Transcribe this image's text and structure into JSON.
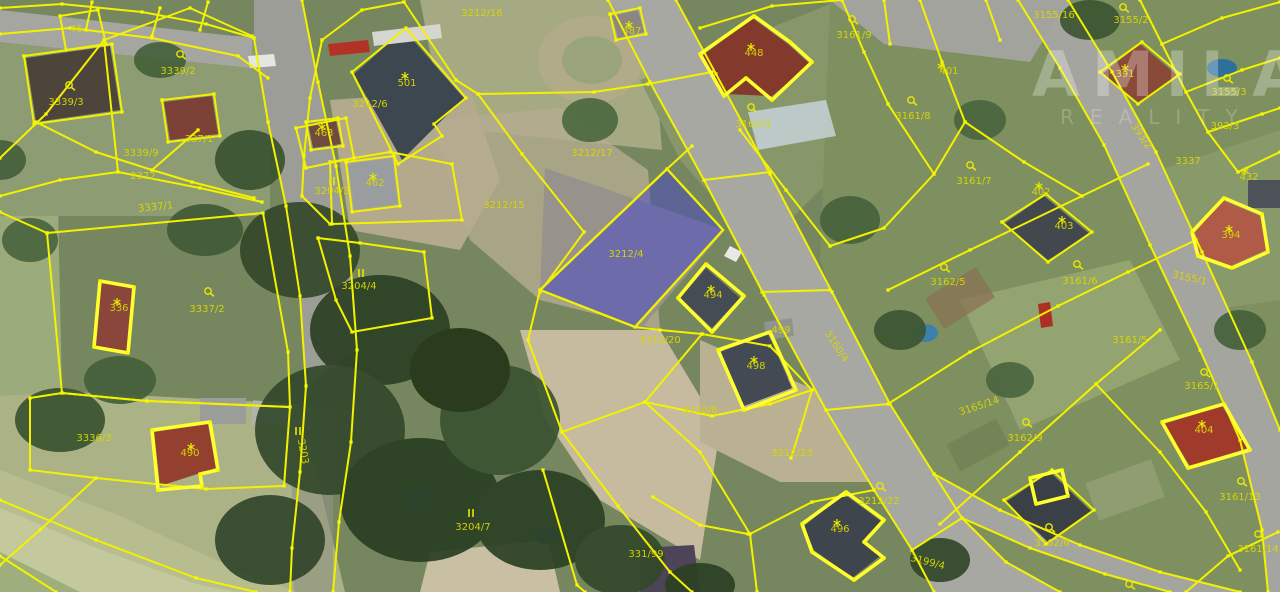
{
  "map": {
    "watermark": {
      "line1": "AMILAS",
      "line2": "REALITY"
    },
    "colors": {
      "boundary_yellow": "#f2f200",
      "highlight_yellow": "#ffff2e",
      "selected_parcel_fill": "#4646c8",
      "label_yellow": "#d8d800"
    },
    "selected_parcel_label": "3212/4",
    "parcel_labels": [
      {
        "text": "46",
        "x": 76,
        "y": 32
      },
      {
        "text": "3339/2",
        "x": 178,
        "y": 74,
        "sym": "landuse",
        "sx": 180,
        "sy": 54
      },
      {
        "text": "3339/3",
        "x": 66,
        "y": 105,
        "sym": "landuse",
        "sx": 69,
        "sy": 85
      },
      {
        "text": "3339/9",
        "x": 141,
        "y": 156
      },
      {
        "text": "337/1",
        "x": 199,
        "y": 142
      },
      {
        "text": "2372",
        "x": 143,
        "y": 179
      },
      {
        "text": "3337/1",
        "x": 156,
        "y": 210,
        "rot": -6
      },
      {
        "text": "336",
        "x": 119,
        "y": 311,
        "sym": "star",
        "sx": 117,
        "sy": 302
      },
      {
        "text": "3337/2",
        "x": 207,
        "y": 312,
        "sym": "landuse",
        "sx": 208,
        "sy": 291
      },
      {
        "text": "3336/3",
        "x": 94,
        "y": 441
      },
      {
        "text": "490",
        "x": 190,
        "y": 456,
        "sym": "star",
        "sx": 191,
        "sy": 447
      },
      {
        "text": "3203",
        "x": 300,
        "y": 452,
        "rot": 80,
        "sym": "parallel",
        "sx": 298,
        "sy": 431
      },
      {
        "text": "3204/4",
        "x": 359,
        "y": 289,
        "sym": "parallel",
        "sx": 361,
        "sy": 273
      },
      {
        "text": "3204/3",
        "x": 332,
        "y": 194,
        "sym": "parallel",
        "sx": 332,
        "sy": 181
      },
      {
        "text": "462",
        "x": 375,
        "y": 186,
        "sym": "star",
        "sx": 373,
        "sy": 177
      },
      {
        "text": "463",
        "x": 324,
        "y": 136,
        "sym": "star",
        "sx": 322,
        "sy": 127
      },
      {
        "text": "501",
        "x": 407,
        "y": 86,
        "sym": "star",
        "sx": 405,
        "sy": 76
      },
      {
        "text": "3212/6",
        "x": 370,
        "y": 107
      },
      {
        "text": "3212/16",
        "x": 482,
        "y": 16
      },
      {
        "text": "3212/17",
        "x": 592,
        "y": 156
      },
      {
        "text": "3212/15",
        "x": 504,
        "y": 208
      },
      {
        "text": "3204/7",
        "x": 473,
        "y": 530,
        "sym": "parallel",
        "sx": 471,
        "sy": 513
      },
      {
        "text": "331/99",
        "x": 646,
        "y": 557
      },
      {
        "text": "3212/20",
        "x": 660,
        "y": 343
      },
      {
        "text": "3210/8",
        "x": 700,
        "y": 413
      },
      {
        "text": "3212/23",
        "x": 792,
        "y": 456
      },
      {
        "text": "3199/4",
        "x": 927,
        "y": 565,
        "rot": 14
      },
      {
        "text": "496",
        "x": 840,
        "y": 532,
        "sym": "star",
        "sx": 837,
        "sy": 523
      },
      {
        "text": "3212/22",
        "x": 879,
        "y": 504,
        "sym": "landuse",
        "sx": 880,
        "sy": 486
      },
      {
        "text": "498",
        "x": 756,
        "y": 369,
        "sym": "star",
        "sx": 754,
        "sy": 360
      },
      {
        "text": "499",
        "x": 781,
        "y": 333
      },
      {
        "text": "494",
        "x": 713,
        "y": 298,
        "sym": "star",
        "sx": 711,
        "sy": 289
      },
      {
        "text": "3212/4",
        "x": 626,
        "y": 257,
        "faint": true
      },
      {
        "text": "487",
        "x": 632,
        "y": 34,
        "sym": "star",
        "sx": 629,
        "sy": 25
      },
      {
        "text": "448",
        "x": 754,
        "y": 56,
        "sym": "star",
        "sx": 751,
        "sy": 47
      },
      {
        "text": "3162/4",
        "x": 753,
        "y": 127,
        "sym": "landuse",
        "sx": 751,
        "sy": 107
      },
      {
        "text": "3161/9",
        "x": 854,
        "y": 38,
        "sym": "landuse",
        "sx": 852,
        "sy": 19
      },
      {
        "text": "3161/8",
        "x": 913,
        "y": 119,
        "sym": "landuse",
        "sx": 911,
        "sy": 100
      },
      {
        "text": "401",
        "x": 949,
        "y": 74,
        "sym": "star",
        "sx": 941,
        "sy": 66
      },
      {
        "text": "3155/16",
        "x": 1054,
        "y": 18
      },
      {
        "text": "3155/2",
        "x": 1131,
        "y": 23,
        "sym": "landuse",
        "sx": 1123,
        "sy": 7
      },
      {
        "text": "391",
        "x": 1125,
        "y": 77,
        "sym": "star",
        "sx": 1125,
        "sy": 68
      },
      {
        "text": "3155/3",
        "x": 1229,
        "y": 95,
        "sym": "landuse",
        "sx": 1227,
        "sy": 78
      },
      {
        "text": "393/3",
        "x": 1225,
        "y": 129
      },
      {
        "text": "393/2",
        "x": 1139,
        "y": 138,
        "rot": 55
      },
      {
        "text": "3337",
        "x": 1188,
        "y": 164
      },
      {
        "text": "402",
        "x": 1041,
        "y": 195,
        "sym": "star",
        "sx": 1039,
        "sy": 186
      },
      {
        "text": "3161/7",
        "x": 974,
        "y": 184,
        "sym": "landuse",
        "sx": 970,
        "sy": 165
      },
      {
        "text": "432",
        "x": 1249,
        "y": 180,
        "sym": "star",
        "sx": 1245,
        "sy": 171
      },
      {
        "text": "403",
        "x": 1064,
        "y": 229,
        "sym": "star",
        "sx": 1062,
        "sy": 220
      },
      {
        "text": "3161/6",
        "x": 1080,
        "y": 284,
        "sym": "landuse",
        "sx": 1077,
        "sy": 264
      },
      {
        "text": "3162/5",
        "x": 948,
        "y": 285,
        "sym": "landuse",
        "sx": 944,
        "sy": 267
      },
      {
        "text": "3155/1",
        "x": 1189,
        "y": 281,
        "rot": 12
      },
      {
        "text": "394",
        "x": 1231,
        "y": 238,
        "sym": "star",
        "sx": 1229,
        "sy": 229
      },
      {
        "text": "3161/5",
        "x": 1130,
        "y": 343
      },
      {
        "text": "3165/14",
        "x": 980,
        "y": 409,
        "rot": -18
      },
      {
        "text": "3165/1",
        "x": 1202,
        "y": 389,
        "sym": "landuse",
        "sx": 1204,
        "sy": 372
      },
      {
        "text": "3162/9",
        "x": 1025,
        "y": 441,
        "sym": "landuse",
        "sx": 1026,
        "sy": 422
      },
      {
        "text": "404",
        "x": 1204,
        "y": 433,
        "sym": "star",
        "sx": 1202,
        "sy": 424
      },
      {
        "text": "3161/13",
        "x": 1240,
        "y": 500,
        "sym": "landuse",
        "sx": 1241,
        "sy": 481
      },
      {
        "text": "3162/6",
        "x": 1052,
        "y": 546,
        "sym": "landuse",
        "sx": 1049,
        "sy": 527
      },
      {
        "text": "3161/14",
        "x": 1258,
        "y": 552,
        "sym": "landuse",
        "sx": 1258,
        "sy": 534
      },
      {
        "text": "3160/4",
        "x": 834,
        "y": 348,
        "rot": 57
      },
      {
        "text": "",
        "x": 1131,
        "y": 590,
        "sym": "landuse",
        "sx": 1129,
        "sy": 584
      }
    ]
  }
}
